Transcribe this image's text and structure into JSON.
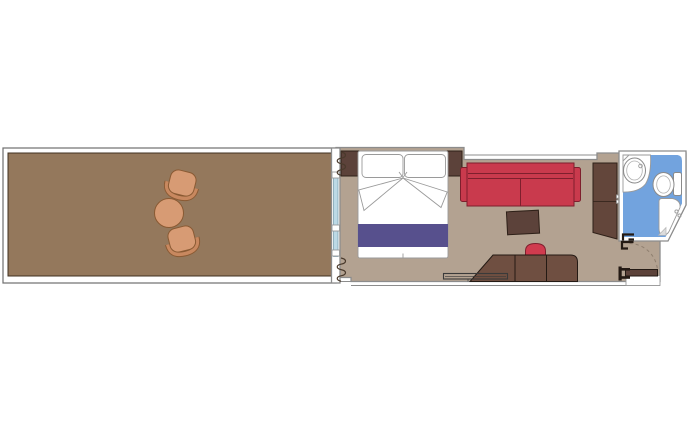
{
  "canvas": {
    "width": 700,
    "height": 433,
    "background": "#ffffff"
  },
  "colors": {
    "wall_white": "#ffffff",
    "balcony_floor": "#94785c",
    "balcony_furniture": "#d79b74",
    "balcony_furniture_rim": "#c8885f",
    "cabin_floor": "#b3a291",
    "dark_wood": "#5c423a",
    "mid_wood": "#6f4f41",
    "wardrobe_wood": "#63463b",
    "sofa_red": "#c93a4d",
    "stool_red": "#d03b4e",
    "bed_white": "#ffffff",
    "bed_runner_blue": "#57508d",
    "bathroom_floor_blue": "#72a3de",
    "glass_blue": "#bcd9e6",
    "fixture_white": "#ffffff",
    "drain_gray": "#dcdcdc",
    "door_symbol_dark": "#241a14"
  },
  "floorplan": {
    "type": "cabin-with-balcony-floor-plan",
    "rooms": [
      {
        "name": "balcony",
        "furniture": [
          "armchair",
          "armchair",
          "round-table"
        ],
        "features": [
          "railing"
        ]
      },
      {
        "name": "cabin",
        "furniture": [
          "double-bed",
          "pillow",
          "pillow",
          "headboard",
          "sofa",
          "coffee-table",
          "wardrobe",
          "desk",
          "stool",
          "luggage-rack"
        ],
        "features": [
          "sliding-glass-door",
          "curtains"
        ]
      },
      {
        "name": "bathroom",
        "furniture": [
          "washbasin",
          "toilet",
          "shower"
        ],
        "features": [
          "door-stop"
        ]
      },
      {
        "name": "entrance",
        "features": [
          "door-leaf",
          "door-swing-arc",
          "door-jambs",
          "landing"
        ]
      }
    ]
  }
}
